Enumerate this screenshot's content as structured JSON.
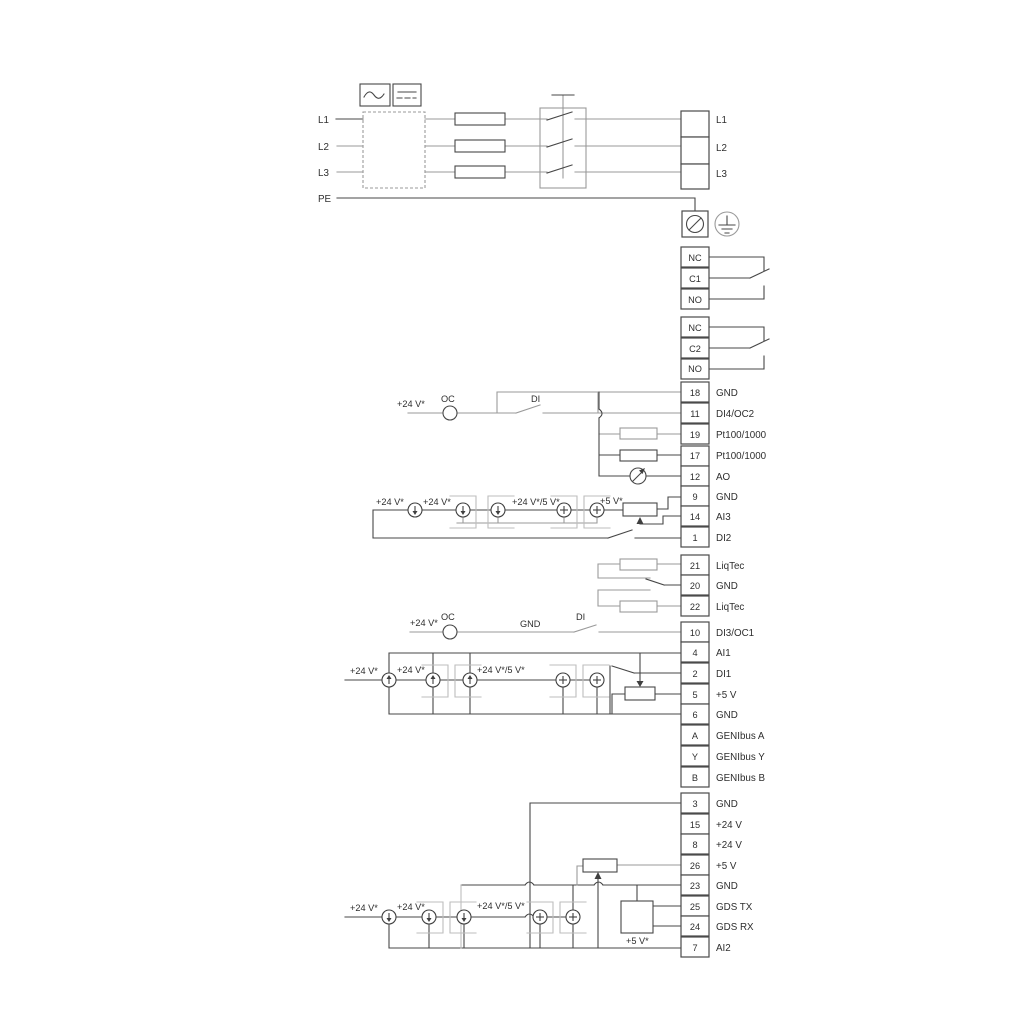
{
  "power": {
    "in": [
      {
        "label": "L1"
      },
      {
        "label": "L2"
      },
      {
        "label": "L3"
      },
      {
        "label": "PE"
      }
    ],
    "out": [
      {
        "label": "L1"
      },
      {
        "label": "L2"
      },
      {
        "label": "L3"
      }
    ]
  },
  "relays": [
    {
      "terminals": [
        {
          "label": "NC"
        },
        {
          "label": "C1"
        },
        {
          "label": "NO"
        }
      ]
    },
    {
      "terminals": [
        {
          "label": "NC"
        },
        {
          "label": "C2"
        },
        {
          "label": "NO"
        }
      ]
    }
  ],
  "strip_a": [
    {
      "num": "18",
      "label": "GND"
    },
    {
      "num": "11",
      "label": "DI4/OC2"
    },
    {
      "num": "19",
      "label": "Pt100/1000"
    },
    {
      "num": "17",
      "label": "Pt100/1000"
    },
    {
      "num": "12",
      "label": "AO"
    },
    {
      "num": "9",
      "label": "GND"
    },
    {
      "num": "14",
      "label": "AI3"
    },
    {
      "num": "1",
      "label": "DI2"
    }
  ],
  "strip_liqtec": [
    {
      "num": "21",
      "label": "LiqTec"
    },
    {
      "num": "20",
      "label": "GND"
    },
    {
      "num": "22",
      "label": "LiqTec"
    }
  ],
  "strip_b": [
    {
      "num": "10",
      "label": "DI3/OC1"
    },
    {
      "num": "4",
      "label": "AI1"
    },
    {
      "num": "2",
      "label": "DI1"
    },
    {
      "num": "5",
      "label": "+5 V"
    },
    {
      "num": "6",
      "label": "GND"
    },
    {
      "num": "A",
      "label": "GENIbus A"
    },
    {
      "num": "Y",
      "label": "GENIbus Y"
    },
    {
      "num": "B",
      "label": "GENIbus B"
    }
  ],
  "strip_c": [
    {
      "num": "3",
      "label": "GND"
    },
    {
      "num": "15",
      "label": "+24 V"
    },
    {
      "num": "8",
      "label": "+24 V"
    },
    {
      "num": "26",
      "label": "+5 V"
    },
    {
      "num": "23",
      "label": "GND"
    },
    {
      "num": "25",
      "label": "GDS TX"
    },
    {
      "num": "24",
      "label": "GDS RX"
    },
    {
      "num": "7",
      "label": "AI2"
    }
  ],
  "ann": {
    "v24": "+24 V*",
    "v24v5": "+24 V*/5 V*",
    "v5": "+5 V*",
    "oc": "OC",
    "di": "DI",
    "gnd": "GND"
  },
  "colors": {
    "line": "#474747",
    "gray_line": "#9a9a9a",
    "background": "#ffffff"
  }
}
